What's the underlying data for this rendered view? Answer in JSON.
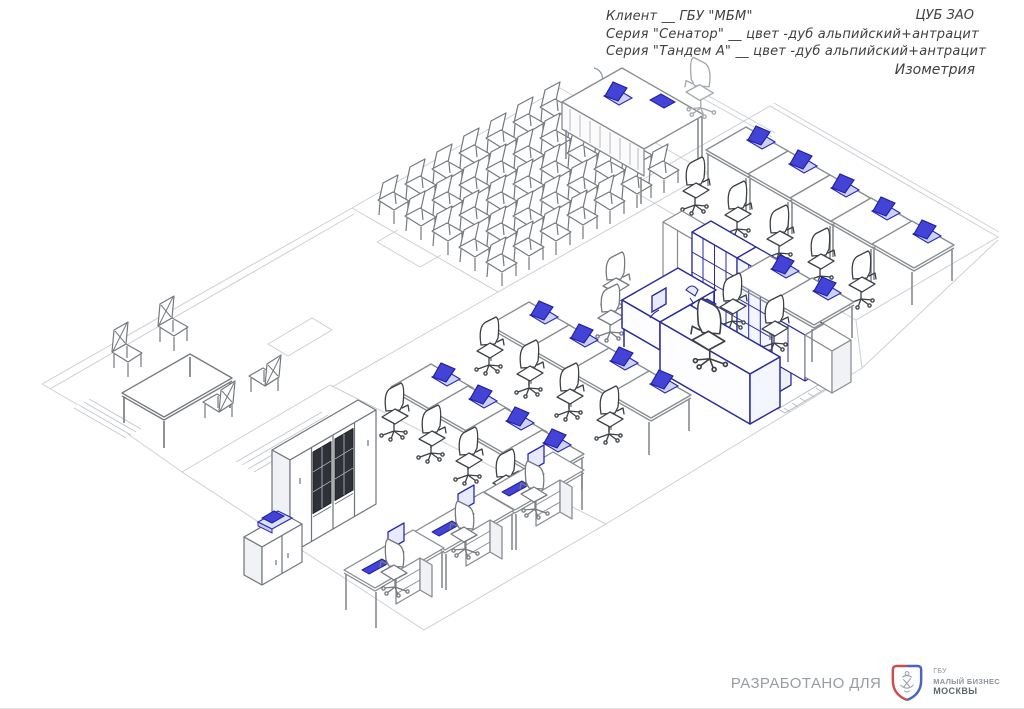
{
  "title_block": {
    "client_line": "Клиент __ ГБУ \"МБМ\"",
    "project_code": "ЦУБ ЗАО",
    "series_lines": [
      "Серия \"Сенатор\" __ цвет -дуб альпийский+антрацит",
      "Серия \"Тандем А\" __ цвет -дуб альпийский+антрацит"
    ],
    "view_label": "Изометрия"
  },
  "footer": {
    "developed_for_label": "РАЗРАБОТАНО ДЛЯ",
    "logo": {
      "icon": "moscow-shield-icon",
      "org_abbr": "ГБУ",
      "org_name": "МАЛЫЙ БИЗНЕС",
      "org_city": "МОСКВЫ"
    }
  },
  "drawing": {
    "type": "isometric-office-furniture-plan",
    "accent_laptop_blue": "#4040cf",
    "cabinet_navy": "#2b2b9d",
    "furniture_gray": "#878c91",
    "floor_line_gray": "#ccd0d5",
    "chair_dark": "#3c4044",
    "text_color": "#3f3f3f",
    "footer_text_gray": "#979da2",
    "logo_red": "#c94f4f",
    "logo_blue": "#4a63c9"
  }
}
